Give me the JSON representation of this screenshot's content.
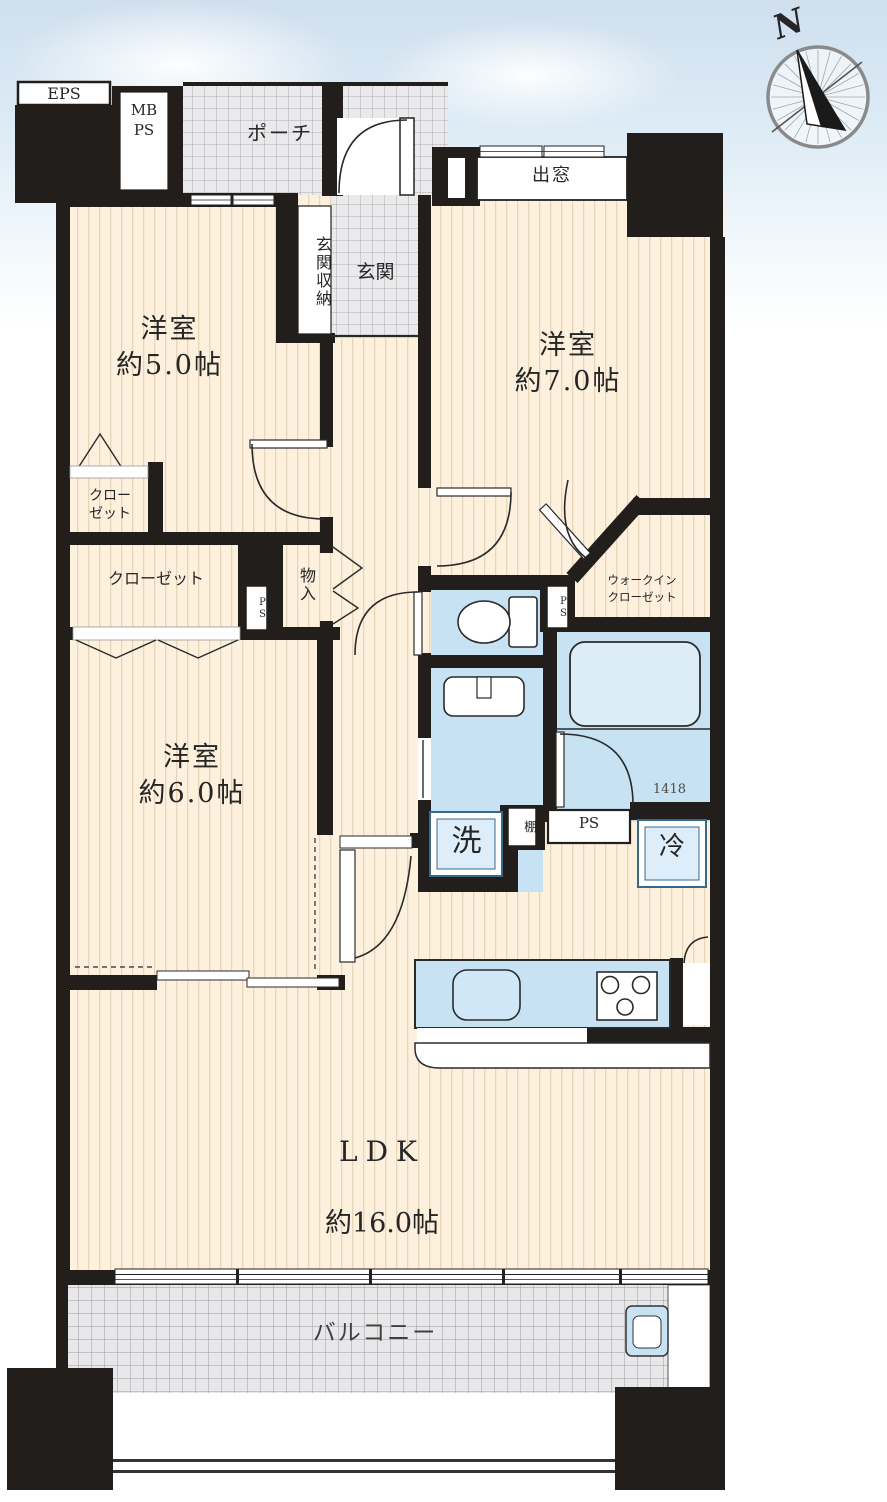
{
  "compass": {
    "north_label": "N"
  },
  "labels": {
    "eps": "EPS",
    "meter_pipe_space": "MB\nPS",
    "porch": "ポーチ",
    "entrance_storage": "玄関収納",
    "entrance": "玄関",
    "bay_window": "出窓",
    "closet_1": "クロー\nゼット",
    "closet_2": "クローゼット",
    "storage": "物入",
    "pipe_space_hall": "PS",
    "pipe_space_wic": "PS",
    "pipe_space_bath": "PS",
    "walk_in_closet": "ウォークイン\nクローゼット",
    "bath_size": "1418",
    "laundry": "洗",
    "shelf": "棚",
    "refrigerator": "冷",
    "balcony": "バルコニー"
  },
  "rooms": {
    "bedroom_5": {
      "label": "洋室\n約5.0帖"
    },
    "bedroom_7": {
      "label": "洋室\n約7.0帖"
    },
    "bedroom_6": {
      "label": "洋室\n約6.0帖"
    },
    "ldk": {
      "name": "LDK",
      "size": "約16.0帖"
    }
  },
  "colors": {
    "wall": "#221e1b",
    "floor": "#fdf0dd",
    "floor_stripe": "#e8d6ba",
    "water": "#c6e2f3",
    "water_light": "#ddeefa",
    "tile": "#eaeaec",
    "tile_line": "#adadb2",
    "balcony_tile": "#e8e8ea",
    "balcony_line": "#9c9ca2",
    "fixture_border": "#38688a",
    "sky": "#cfdfee"
  }
}
